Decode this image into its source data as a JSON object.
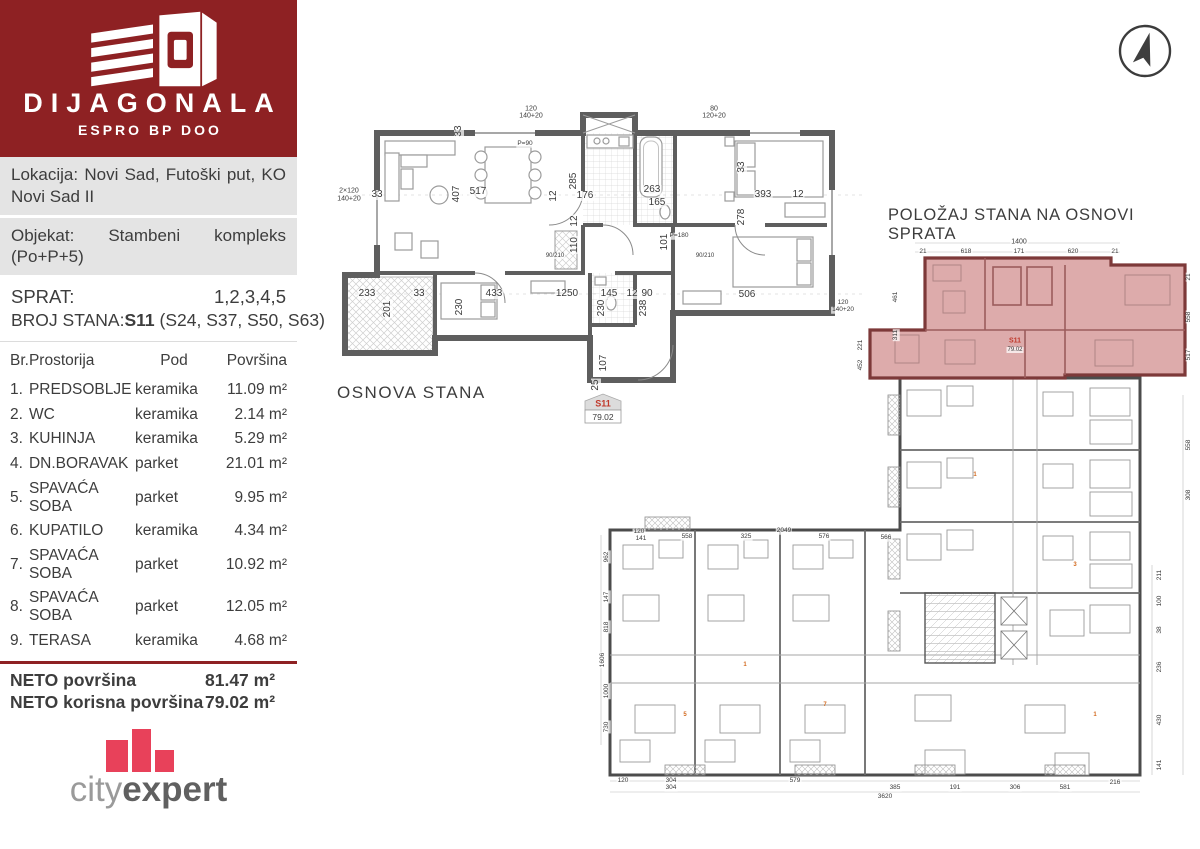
{
  "brand": {
    "name": "DIJAGONALA",
    "subtitle": "ESPRO BP DOO",
    "bg_color": "#8e2123",
    "logo_icon": "building-logo-icon"
  },
  "info": {
    "lokacija": "Lokacija: Novi Sad, Futoški put, KO Novi Sad II",
    "objekat": "Objekat: Stambeni kompleks (Po+P+5)"
  },
  "unit_info": {
    "sprat_label": "SPRAT:",
    "sprat_value": "1,2,3,4,5",
    "broj_label": "BROJ STANA:",
    "broj_value": "S11",
    "broj_extra": "(S24, S37, S50, S63)"
  },
  "rooms_table": {
    "headers": {
      "br": "Br.",
      "prostorija": "Prostorija",
      "pod": "Pod",
      "povrsina": "Površina"
    },
    "rows": [
      {
        "br": "1.",
        "name": "PREDSOBLJE",
        "pod": "keramika",
        "area": "11.09 m²"
      },
      {
        "br": "2.",
        "name": "WC",
        "pod": "keramika",
        "area": "2.14 m²"
      },
      {
        "br": "3.",
        "name": "KUHINJA",
        "pod": "keramika",
        "area": "5.29 m²"
      },
      {
        "br": "4.",
        "name": "DN.BORAVAK",
        "pod": "parket",
        "area": "21.01 m²"
      },
      {
        "br": "5.",
        "name": "SPAVAĆA SOBA",
        "pod": "parket",
        "area": "9.95 m²"
      },
      {
        "br": "6.",
        "name": "KUPATILO",
        "pod": "keramika",
        "area": "4.34 m²"
      },
      {
        "br": "7.",
        "name": "SPAVAĆA SOBA",
        "pod": "parket",
        "area": "10.92 m²"
      },
      {
        "br": "8.",
        "name": "SPAVAĆA SOBA",
        "pod": "parket",
        "area": "12.05 m²"
      },
      {
        "br": "9.",
        "name": "TERASA",
        "pod": "keramika",
        "area": "4.68 m²"
      }
    ]
  },
  "totals": {
    "rows": [
      {
        "label": "NETO površina",
        "value": "81.47 m²"
      },
      {
        "label": "NETO korisna površina",
        "value": "79.02 m²"
      }
    ]
  },
  "footer_logo": {
    "part1": "city",
    "part2": "expert",
    "bar_color": "#e8415a"
  },
  "colors": {
    "accent_red": "#8e2123",
    "highlight_fill": "#ddabab",
    "highlight_wall": "#7d3939",
    "wall_gray": "#5e5e5e"
  },
  "osnova": {
    "title": "OSNOVA STANA",
    "badge": {
      "unit": "S11",
      "area": "79.02"
    },
    "labels": [
      {
        "t": "33",
        "x": 124,
        "y": 36,
        "r": 90
      },
      {
        "t": "517",
        "x": 143,
        "y": 97
      },
      {
        "t": "407",
        "x": 122,
        "y": 99,
        "r": 90
      },
      {
        "t": "33",
        "x": 42,
        "y": 100
      },
      {
        "t": "12",
        "x": 219,
        "y": 101,
        "r": 90
      },
      {
        "t": "285",
        "x": 239,
        "y": 86,
        "r": 90
      },
      {
        "t": "176",
        "x": 250,
        "y": 101
      },
      {
        "t": "263",
        "x": 317,
        "y": 95
      },
      {
        "t": "165",
        "x": 322,
        "y": 108
      },
      {
        "t": "12",
        "x": 463,
        "y": 100
      },
      {
        "t": "393",
        "x": 428,
        "y": 100
      },
      {
        "t": "278",
        "x": 407,
        "y": 122,
        "r": 90
      },
      {
        "t": "33",
        "x": 407,
        "y": 72,
        "r": 90
      },
      {
        "t": "12",
        "x": 240,
        "y": 126,
        "r": 90
      },
      {
        "t": "110",
        "x": 240,
        "y": 150,
        "r": 90
      },
      {
        "t": "101",
        "x": 330,
        "y": 147,
        "r": 90
      },
      {
        "t": "233",
        "x": 32,
        "y": 199
      },
      {
        "t": "201",
        "x": 53,
        "y": 214,
        "r": 90
      },
      {
        "t": "33",
        "x": 84,
        "y": 199
      },
      {
        "t": "433",
        "x": 159,
        "y": 199
      },
      {
        "t": "230",
        "x": 125,
        "y": 212,
        "r": 90
      },
      {
        "t": "1250",
        "x": 232,
        "y": 199
      },
      {
        "t": "145",
        "x": 274,
        "y": 199
      },
      {
        "t": "12",
        "x": 297,
        "y": 199
      },
      {
        "t": "90",
        "x": 312,
        "y": 199
      },
      {
        "t": "230",
        "x": 267,
        "y": 213,
        "r": 90
      },
      {
        "t": "238",
        "x": 309,
        "y": 213,
        "r": 90
      },
      {
        "t": "506",
        "x": 412,
        "y": 200
      },
      {
        "t": "107",
        "x": 269,
        "y": 268,
        "r": 90
      },
      {
        "t": "25",
        "x": 261,
        "y": 290,
        "r": 90
      },
      {
        "t": "2×120",
        "x": 14,
        "y": 96,
        "s": 7
      },
      {
        "t": "140+20",
        "x": 14,
        "y": 104,
        "s": 7
      },
      {
        "t": "120",
        "x": 196,
        "y": 14,
        "s": 7
      },
      {
        "t": "140+20",
        "x": 196,
        "y": 21,
        "s": 7
      },
      {
        "t": "80",
        "x": 379,
        "y": 14,
        "s": 7
      },
      {
        "t": "120+20",
        "x": 379,
        "y": 21,
        "s": 7
      },
      {
        "t": "120",
        "x": 508,
        "y": 208,
        "s": 6.5
      },
      {
        "t": "140+20",
        "x": 508,
        "y": 215,
        "s": 6.5
      },
      {
        "t": "P=90",
        "x": 190,
        "y": 49,
        "s": 6.5
      },
      {
        "t": "P=180",
        "x": 344,
        "y": 141,
        "s": 6.5
      },
      {
        "t": "90/210",
        "x": 370,
        "y": 161,
        "s": 6
      },
      {
        "t": "90/210",
        "x": 220,
        "y": 161,
        "s": 6
      }
    ]
  },
  "polozaj": {
    "title": "POLOŽAJ STANA NA OSNOVI SPRATA",
    "compass_icon": "north-arrow-compass-icon",
    "labels": [
      {
        "t": "1400",
        "x": 424,
        "y": 7,
        "s": 7
      },
      {
        "t": "21",
        "x": 328,
        "y": 17,
        "s": 6.5
      },
      {
        "t": "618",
        "x": 371,
        "y": 17,
        "s": 6.5
      },
      {
        "t": "171",
        "x": 424,
        "y": 17,
        "s": 6.5
      },
      {
        "t": "620",
        "x": 478,
        "y": 17,
        "s": 6.5
      },
      {
        "t": "21",
        "x": 520,
        "y": 17,
        "s": 6.5
      },
      {
        "t": "461",
        "x": 301,
        "y": 62,
        "s": 6.5,
        "r": 90
      },
      {
        "t": "311",
        "x": 301,
        "y": 100,
        "s": 6.5,
        "r": 90
      },
      {
        "t": "221",
        "x": 266,
        "y": 110,
        "s": 6.5,
        "r": 90
      },
      {
        "t": "452",
        "x": 266,
        "y": 130,
        "s": 6.5,
        "r": 90
      },
      {
        "t": "S11",
        "x": 420,
        "y": 106,
        "s": 7,
        "c": "#c0392b"
      },
      {
        "t": "79.02",
        "x": 420,
        "y": 115,
        "s": 6
      },
      {
        "t": "21",
        "x": 594,
        "y": 42,
        "s": 6.5,
        "r": 90
      },
      {
        "t": "558",
        "x": 594,
        "y": 82,
        "s": 6.5,
        "r": 90
      },
      {
        "t": "517",
        "x": 594,
        "y": 120,
        "s": 6.5,
        "r": 90
      },
      {
        "t": "558",
        "x": 594,
        "y": 210,
        "s": 6.5,
        "r": 90
      },
      {
        "t": "308",
        "x": 594,
        "y": 260,
        "s": 6.5,
        "r": 90
      },
      {
        "t": "211",
        "x": 565,
        "y": 340,
        "s": 6.5,
        "r": 90
      },
      {
        "t": "100",
        "x": 565,
        "y": 366,
        "s": 6.5,
        "r": 90
      },
      {
        "t": "38",
        "x": 565,
        "y": 395,
        "s": 6.5,
        "r": 90
      },
      {
        "t": "236",
        "x": 565,
        "y": 432,
        "s": 6.5,
        "r": 90
      },
      {
        "t": "430",
        "x": 565,
        "y": 485,
        "s": 6.5,
        "r": 90
      },
      {
        "t": "141",
        "x": 565,
        "y": 530,
        "s": 6.5,
        "r": 90
      },
      {
        "t": "962",
        "x": 12,
        "y": 322,
        "s": 6.5,
        "r": 90
      },
      {
        "t": "147",
        "x": 12,
        "y": 362,
        "s": 6.5,
        "r": 90
      },
      {
        "t": "818",
        "x": 12,
        "y": 392,
        "s": 6.5,
        "r": 90
      },
      {
        "t": "1606",
        "x": 8,
        "y": 425,
        "s": 6.5,
        "r": 90
      },
      {
        "t": "1000",
        "x": 12,
        "y": 456,
        "s": 6.5,
        "r": 90
      },
      {
        "t": "730",
        "x": 12,
        "y": 492,
        "s": 6.5,
        "r": 90
      },
      {
        "t": "120",
        "x": 44,
        "y": 297,
        "s": 6.5
      },
      {
        "t": "141",
        "x": 46,
        "y": 304,
        "s": 6.5
      },
      {
        "t": "558",
        "x": 92,
        "y": 302,
        "s": 6.5
      },
      {
        "t": "325",
        "x": 151,
        "y": 302,
        "s": 6.5
      },
      {
        "t": "2049",
        "x": 189,
        "y": 296,
        "s": 6.5
      },
      {
        "t": "576",
        "x": 229,
        "y": 302,
        "s": 6.5
      },
      {
        "t": "566",
        "x": 291,
        "y": 303,
        "s": 6.5
      },
      {
        "t": "120",
        "x": 28,
        "y": 546,
        "s": 6.5
      },
      {
        "t": "304",
        "x": 76,
        "y": 546,
        "s": 6.5
      },
      {
        "t": "579",
        "x": 200,
        "y": 546,
        "s": 6.5
      },
      {
        "t": "304",
        "x": 76,
        "y": 553,
        "s": 6.5
      },
      {
        "t": "385",
        "x": 300,
        "y": 553,
        "s": 6.5
      },
      {
        "t": "191",
        "x": 360,
        "y": 553,
        "s": 6.5
      },
      {
        "t": "306",
        "x": 420,
        "y": 553,
        "s": 6.5
      },
      {
        "t": "581",
        "x": 470,
        "y": 553,
        "s": 6.5
      },
      {
        "t": "3620",
        "x": 290,
        "y": 562,
        "s": 6.5
      },
      {
        "t": "216",
        "x": 520,
        "y": 548,
        "s": 6.5
      },
      {
        "t": "1",
        "x": 150,
        "y": 430,
        "s": 6,
        "c": "#d2691e"
      },
      {
        "t": "7",
        "x": 230,
        "y": 470,
        "s": 6,
        "c": "#d2691e"
      },
      {
        "t": "3",
        "x": 480,
        "y": 330,
        "s": 6,
        "c": "#d2691e"
      },
      {
        "t": "1",
        "x": 380,
        "y": 240,
        "s": 6,
        "c": "#d2691e"
      },
      {
        "t": "5",
        "x": 90,
        "y": 480,
        "s": 6,
        "c": "#d2691e"
      },
      {
        "t": "1",
        "x": 500,
        "y": 480,
        "s": 6,
        "c": "#d2691e"
      }
    ]
  }
}
